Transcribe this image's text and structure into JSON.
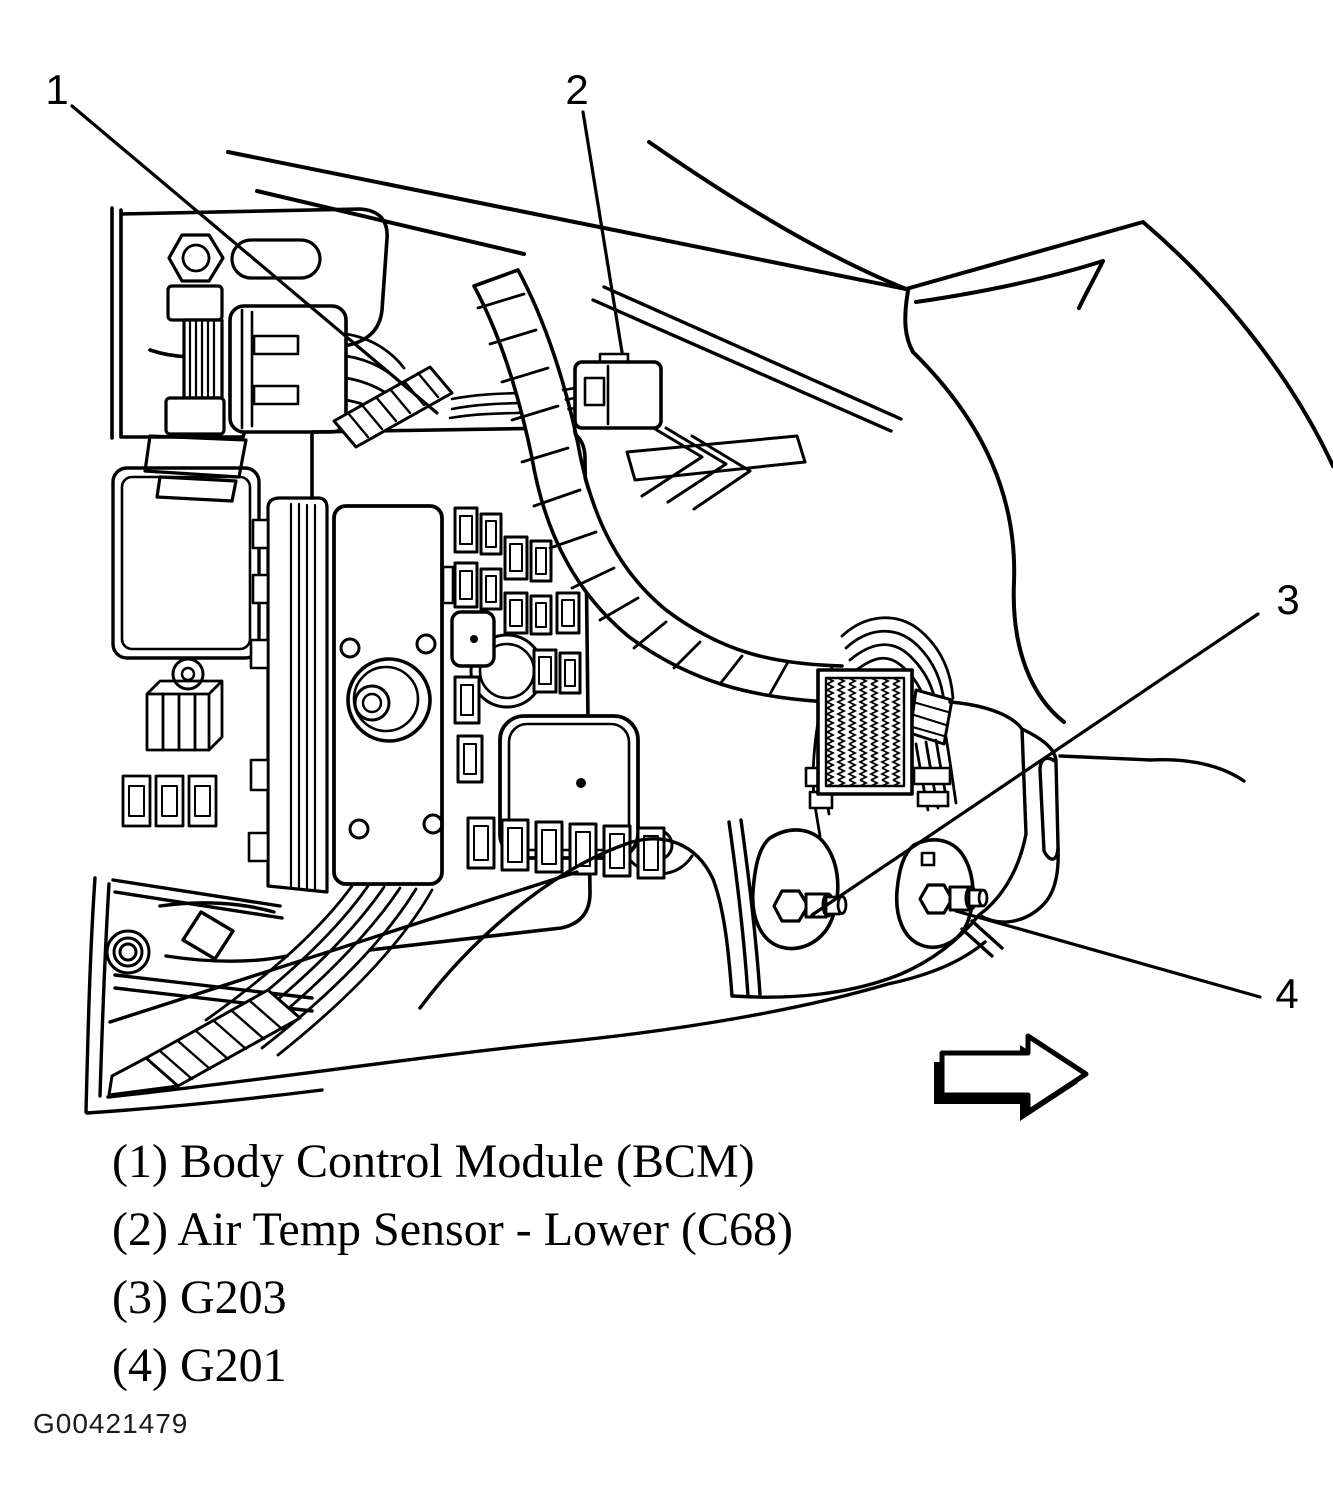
{
  "figure": {
    "id": "G00421479",
    "direction_arrow_icon": "right-arrow"
  },
  "colors": {
    "ink": "#000000",
    "paper": "#ffffff"
  },
  "callouts": [
    {
      "number": "1",
      "label": "Body Control Module (BCM)",
      "legend_text": "(1) Body Control Module (BCM)"
    },
    {
      "number": "2",
      "label": "Air Temp Sensor - Lower (C68)",
      "legend_text": "(2) Air Temp Sensor - Lower (C68)"
    },
    {
      "number": "3",
      "label": "G203",
      "legend_text": "(3) G203"
    },
    {
      "number": "4",
      "label": "G201",
      "legend_text": "(4) G201"
    }
  ]
}
